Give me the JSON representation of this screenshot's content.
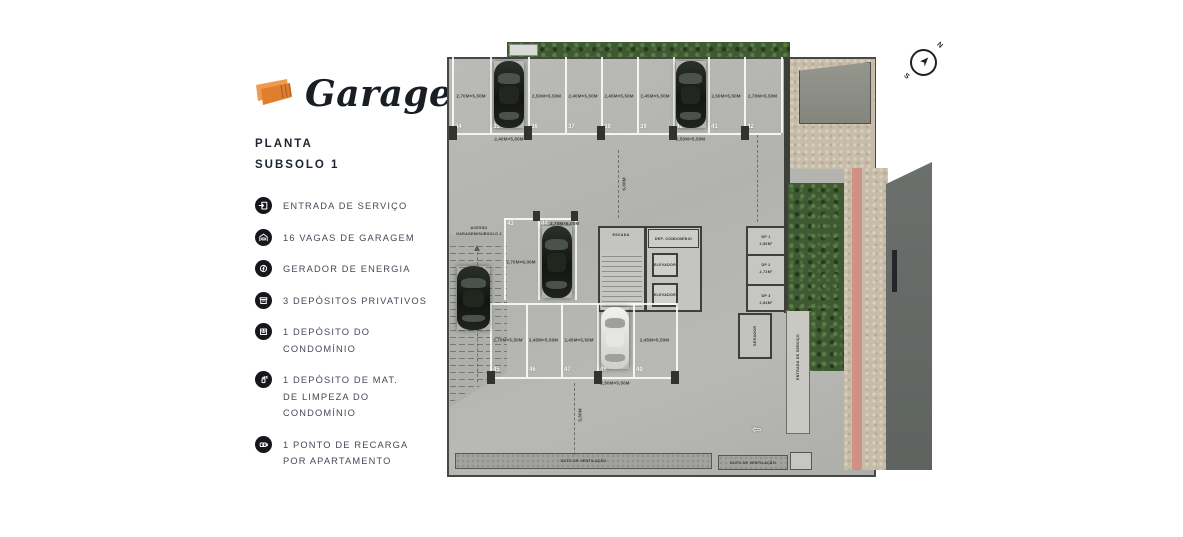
{
  "brand": {
    "logo_text": "Garagens"
  },
  "plan_header": {
    "line1": "PLANTA",
    "line2": "SUBSOLO 1"
  },
  "legend": [
    {
      "icon": "service-entrance-icon",
      "lines": [
        "ENTRADA DE SERVIÇO"
      ]
    },
    {
      "icon": "garage-spaces-icon",
      "lines": [
        "16 VAGAS DE GARAGEM"
      ]
    },
    {
      "icon": "power-generator-icon",
      "lines": [
        "GERADOR DE ENERGIA"
      ]
    },
    {
      "icon": "private-deposit-icon",
      "lines": [
        "3 DEPÓSITOS PRIVATIVOS"
      ]
    },
    {
      "icon": "condo-deposit-icon",
      "lines": [
        "1 DEPÓSITO DO",
        "CONDOMÍNIO"
      ]
    },
    {
      "icon": "cleaning-deposit-icon",
      "lines": [
        "1 DEPÓSITO DE MAT.",
        "DE LIMPEZA DO",
        "CONDOMÍNIO"
      ]
    },
    {
      "icon": "ev-charging-icon",
      "lines": [
        "1 PONTO DE RECARGA",
        "POR APARTAMENTO"
      ]
    }
  ],
  "compass": {
    "north": "N",
    "south": "S"
  },
  "colors": {
    "accent_orange": "#e78a3e",
    "icon_circle": "#15171b",
    "hedge_green": "#3f5a33",
    "tactile_pink": "#d08b7e",
    "road_gray": "#64696a"
  },
  "floor_plan": {
    "top_stalls": [
      {
        "num": "34",
        "dim": "2,70M×5,50M"
      },
      {
        "num": "35",
        "car": "black",
        "dim_below": "2,40M×5,50M"
      },
      {
        "num": "36",
        "dim": "2,50M×5,50M"
      },
      {
        "num": "37",
        "dim": "2,40M×5,50M"
      },
      {
        "num": "38",
        "dim": "2,45M×5,50M"
      },
      {
        "num": "39",
        "dim": "2,45M×5,50M"
      },
      {
        "num": "40",
        "car": "black",
        "dim_below": "2,50M×5,50M"
      },
      {
        "num": "41",
        "dim": "2,50M×5,50M"
      },
      {
        "num": "42",
        "dim": "2,70M×5,50M"
      }
    ],
    "mid_stalls": [
      {
        "num": "43",
        "dim": "2,70M×6,00M"
      },
      {
        "num": "44",
        "dim": "2,70M×6,00M",
        "car": "black"
      }
    ],
    "bottom_stalls": [
      {
        "num": "45",
        "dim": "2,70M×5,50M"
      },
      {
        "num": "46",
        "dim": "2,45M×5,50M"
      },
      {
        "num": "47",
        "dim": "2,45M×5,50M"
      },
      {
        "num": "48",
        "car": "white",
        "dim_below": "2,50M×5,50M"
      },
      {
        "num": "49",
        "dim": "2,45M×5,50M"
      }
    ],
    "rooms": {
      "stairs": "ESCADA",
      "condo_deposit": "DEP. CONDOMÍNIO",
      "elevator1": "ELEVADOR",
      "elevator2": "ELEVADOR",
      "dp1": "DP 1",
      "dp1_area": "2,56M²",
      "dp2": "DP 2",
      "dp2_area": "2,72M²",
      "dp3": "DP 3",
      "dp3_area": "2,84M²",
      "generator": "GERADOR",
      "service_entrance": "ENTRADA DE SERVIÇO"
    },
    "ramp": {
      "line1": "ACESSO",
      "line2": "GARAGEM/SUBSOLO 2"
    },
    "dimensions": {
      "aisle_top": "6,00M",
      "aisle_bottom": "5,50M"
    },
    "ducts": {
      "label1": "DUTO DE VENTILAÇÃO",
      "label2": "DUTO DE VENTILAÇÃO"
    }
  }
}
